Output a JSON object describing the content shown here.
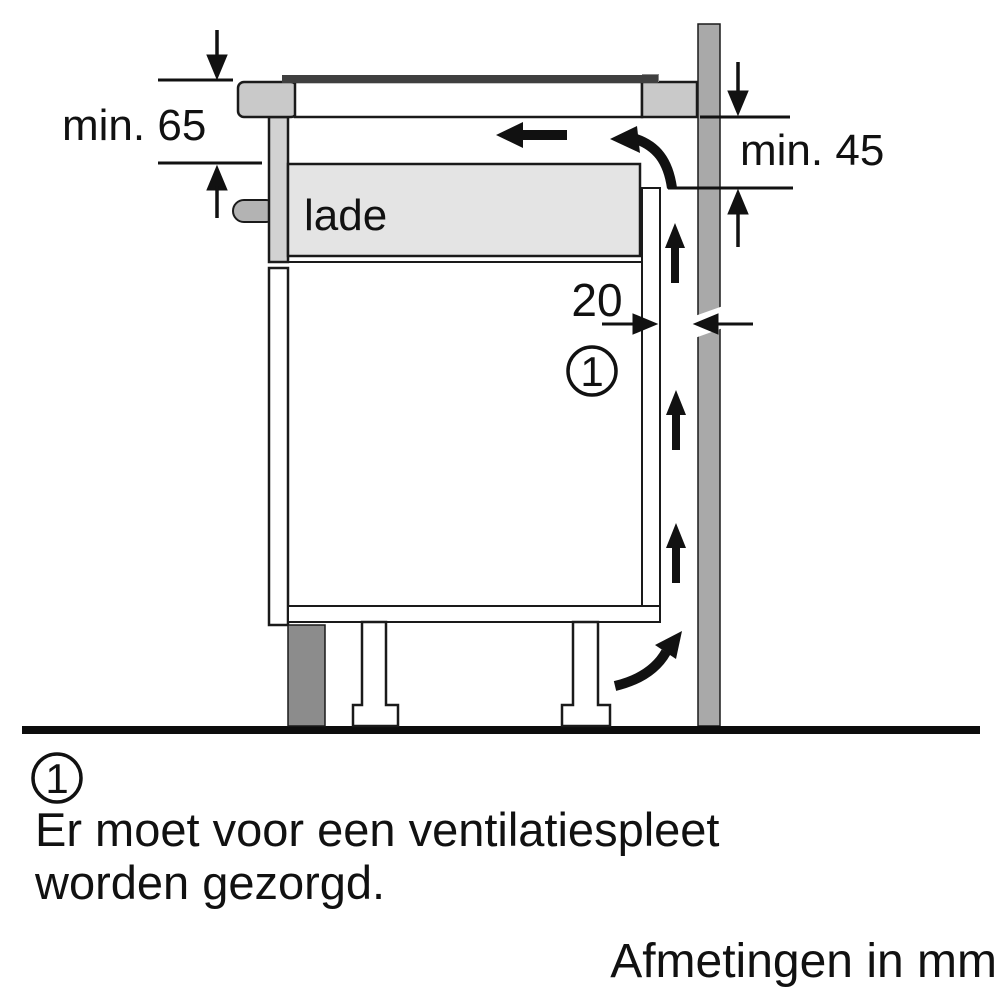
{
  "diagram": {
    "labels": {
      "clearance_top": "min. 65",
      "clearance_wall": "min. 45",
      "ventilation_gap": "20",
      "drawer": "lade",
      "callout": "1"
    },
    "footnote": {
      "marker": "1",
      "line1": "Er moet voor een ventilatiespleet",
      "line2": "worden gezorgd."
    },
    "units_caption": "Afmetingen in mm",
    "colors": {
      "worktop": "#c9c9c9",
      "cooktop_glass": "#3f3f3f",
      "wall": "#a9a9a9",
      "plinth": "#8c8c8c",
      "drawer_box": "#e4e4e4",
      "drawer_front": "#d2d2d2",
      "handle": "#b3b3b3",
      "outline": "#1a1a1a"
    }
  }
}
